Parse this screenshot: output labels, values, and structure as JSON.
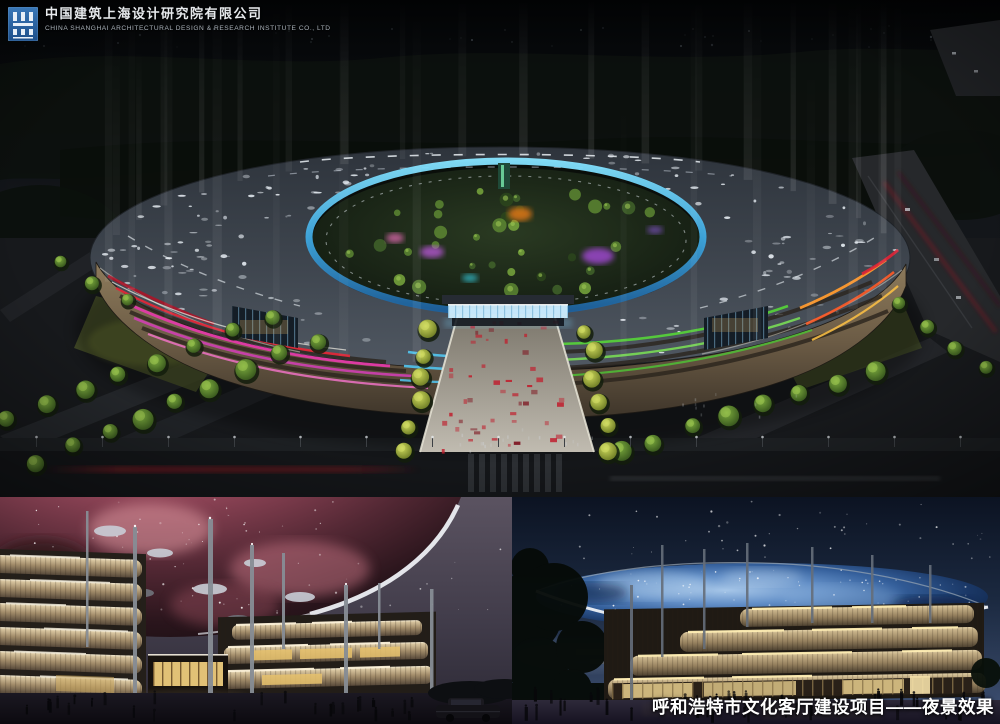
{
  "header": {
    "company_zh": "中国建筑上海设计研究院有限公司",
    "company_en": "CHINA SHANGHAI ARCHITECTURAL DESIGN & RESEARCH INSTITUTE CO., LTD"
  },
  "caption": {
    "text": "呼和浩特市文化客厅建设项目——夜景效果"
  },
  "icons": {
    "logo": "company-seal-icon"
  },
  "palette": {
    "logo_blue": "#2f6fae",
    "night_sky": "#0a0d10",
    "roof_gray": "#3c434d",
    "inner_glass_cyan": "#45c8f2",
    "neon_magenta": "#e23aa8",
    "neon_red": "#df2838",
    "neon_green": "#55cf3a",
    "neon_orange": "#ff9a2e",
    "nebula_pink": "#c06a77",
    "dome_blue": "#35609c",
    "facade_cream": "#cdbb92",
    "tree_green": "#5d8733",
    "walkway_red": "#c01f2e"
  }
}
